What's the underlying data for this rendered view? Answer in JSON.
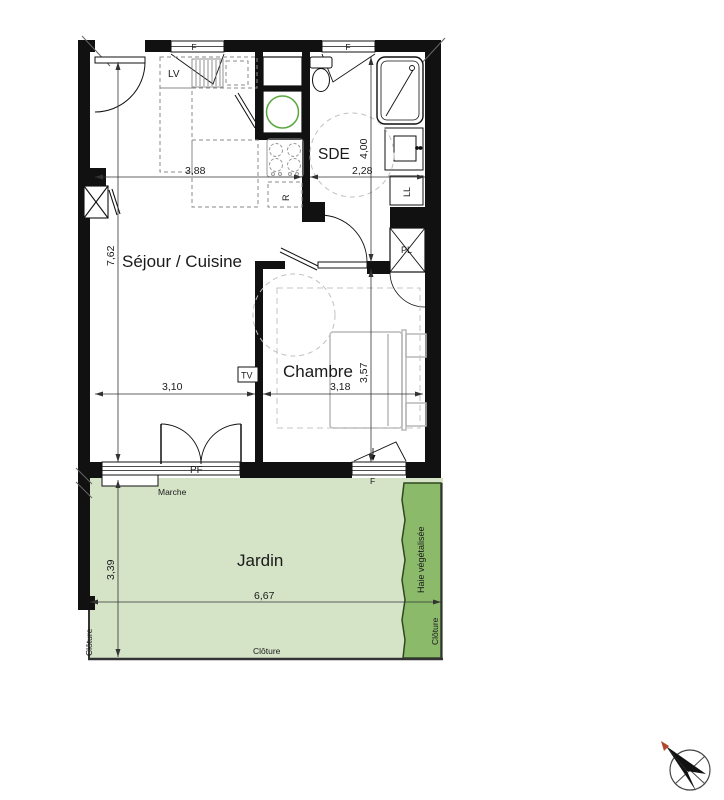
{
  "plan": {
    "rooms": {
      "living": "Séjour / Cuisine",
      "bedroom": "Chambre",
      "bathroom": "SDE",
      "garden": "Jardin"
    },
    "dimensions": {
      "kitchen_width": "3,88",
      "bathroom_width": "2,28",
      "bathroom_depth": "4,00",
      "living_depth": "7,62",
      "living_width": "3,10",
      "bedroom_width": "3,18",
      "bedroom_depth": "3,57",
      "garden_depth": "3,39",
      "garden_width": "6,67"
    },
    "labels": {
      "dishwasher": "LV",
      "fridge": "R",
      "washer": "LL",
      "closet": "PL",
      "tv": "TV",
      "french_door": "PF",
      "window": "F",
      "step": "Marche",
      "fence": "Clôture",
      "hedge": "Haie végétalisée"
    },
    "colors": {
      "wall": "#111111",
      "garden_fill": "#d5e3c7",
      "hedge_fill": "#8cba6b",
      "heater_ring": "#5aa83c"
    }
  }
}
